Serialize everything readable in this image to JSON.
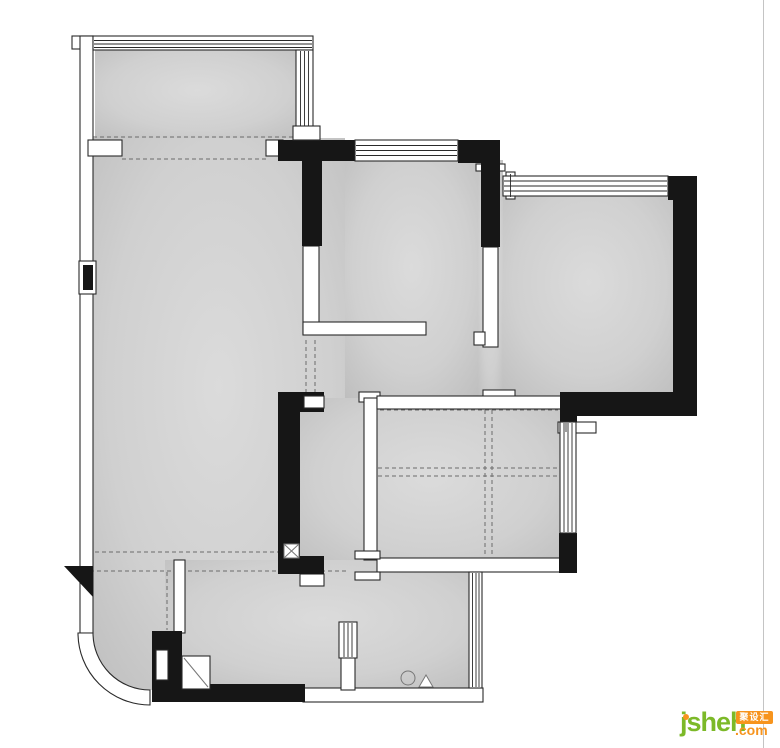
{
  "watermark": {
    "brand": "jsheh",
    "tld": ".com",
    "badge": "聚设汇"
  },
  "colors": {
    "wall": "#161616",
    "line": "#2a2a2a",
    "floor": "#d0d0d0",
    "floor-light": "#dbdbdb",
    "floor-dark": "#b8b8b8",
    "dash": "#6b6b6b",
    "rule": "#c4c4c4",
    "brand-green": "#7cb928",
    "brand-orange": "#f7941d"
  }
}
